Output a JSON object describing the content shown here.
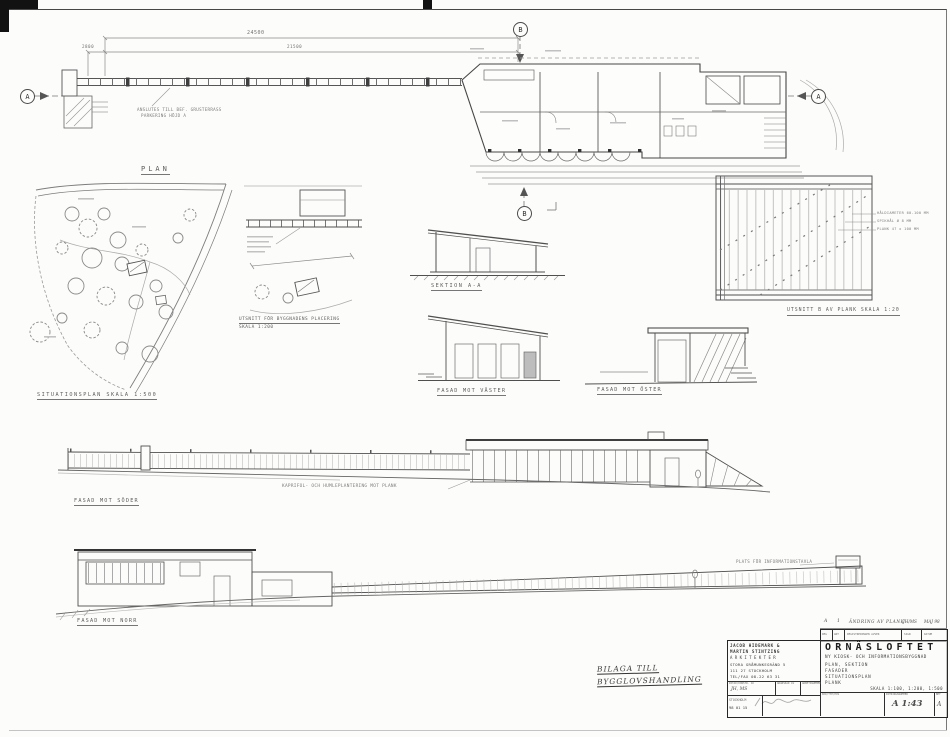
{
  "drawing": {
    "labels": {
      "plan": "PLAN",
      "situationsplan": "SITUATIONSPLAN  SKALA 1:500",
      "placering1": "UTSNITT FÖR BYGGNADENS PLACERING",
      "placering2": "SKALA 1:200",
      "sektion": "SEKTION A-A",
      "fasad_vaster": "FASAD MOT VÄSTER",
      "fasad_oster": "FASAD MOT ÖSTER",
      "plank_detalj": "UTSNITT B AV PLANK  SKALA 1:20",
      "fasad_soder": "FASAD MOT SÖDER",
      "kaprifol": "KAPRIFOL- OCH HUMLEPLANTERING MOT PLANK",
      "fasad_norr": "FASAD MOT NORR",
      "infotavla": "PLATS FÖR INFORMATIONSTAVLA"
    },
    "notes": {
      "plan_note1": "ANSLUTES TILL BEF. GRUSTERRASS",
      "plan_note2": "PARKERING HÖJD A",
      "plank_note1": "HÅLDIAMETER 60-100 MM",
      "plank_note2": "SPIKHÅL Ø 8 MM",
      "plank_note3": "PLANK 47 x 100 MM"
    },
    "dims": {
      "total": "24500",
      "left": "2800",
      "mid": "21500"
    },
    "markers": {
      "a": "A",
      "b": "B"
    }
  },
  "annex": {
    "line1": "BILAGA TILL",
    "line2": "BYGGLOVSHANDLING"
  },
  "revision": {
    "entry": {
      "reg": "A",
      "ant": "1",
      "avser": "ÄNDRING AV PLANK",
      "sign": "JH/MS",
      "datum": "MAJ 98"
    },
    "headers": {
      "reg": "REG",
      "ant": "ANT",
      "avser": "REGISTRERINGEN AVSER",
      "sign": "SIGN",
      "datum": "DATUM"
    }
  },
  "titleblock": {
    "architect": [
      "JACOB HIDEMARK &",
      "MARTIN STINTZING",
      "ARKITEKTER",
      "STORA GRÅMUNKEGRÄND 5",
      "111 27 STOCKHOLM",
      "TEL/FAX 08-22 63 31"
    ],
    "meta_headers": {
      "ritad": "RITAD/KONSTR. AV",
      "granskad": "GRANSKAD AV",
      "arbetsnr": "ARBETSNUMMER"
    },
    "ritad_value": "JH, MS",
    "ort": "STOCKHOLM",
    "datum": "98 01 15",
    "project": "ORNÄSLOFTET",
    "subtitle": "NY KIOSK- OCH INFORMATIONSBYGGNAD",
    "content": [
      "PLAN, SEKTION",
      "FASADER",
      "SITUATIONSPLAN",
      "PLANK"
    ],
    "skala": "SKALA 1:100, 1:200, 1:500",
    "kod_label": "KOD/TYP/POS",
    "ritningsnummer_label": "RITNINGSNUMMER",
    "ritningsnummer": "A 1:43",
    "bet_label": "BET",
    "bet": "A"
  }
}
